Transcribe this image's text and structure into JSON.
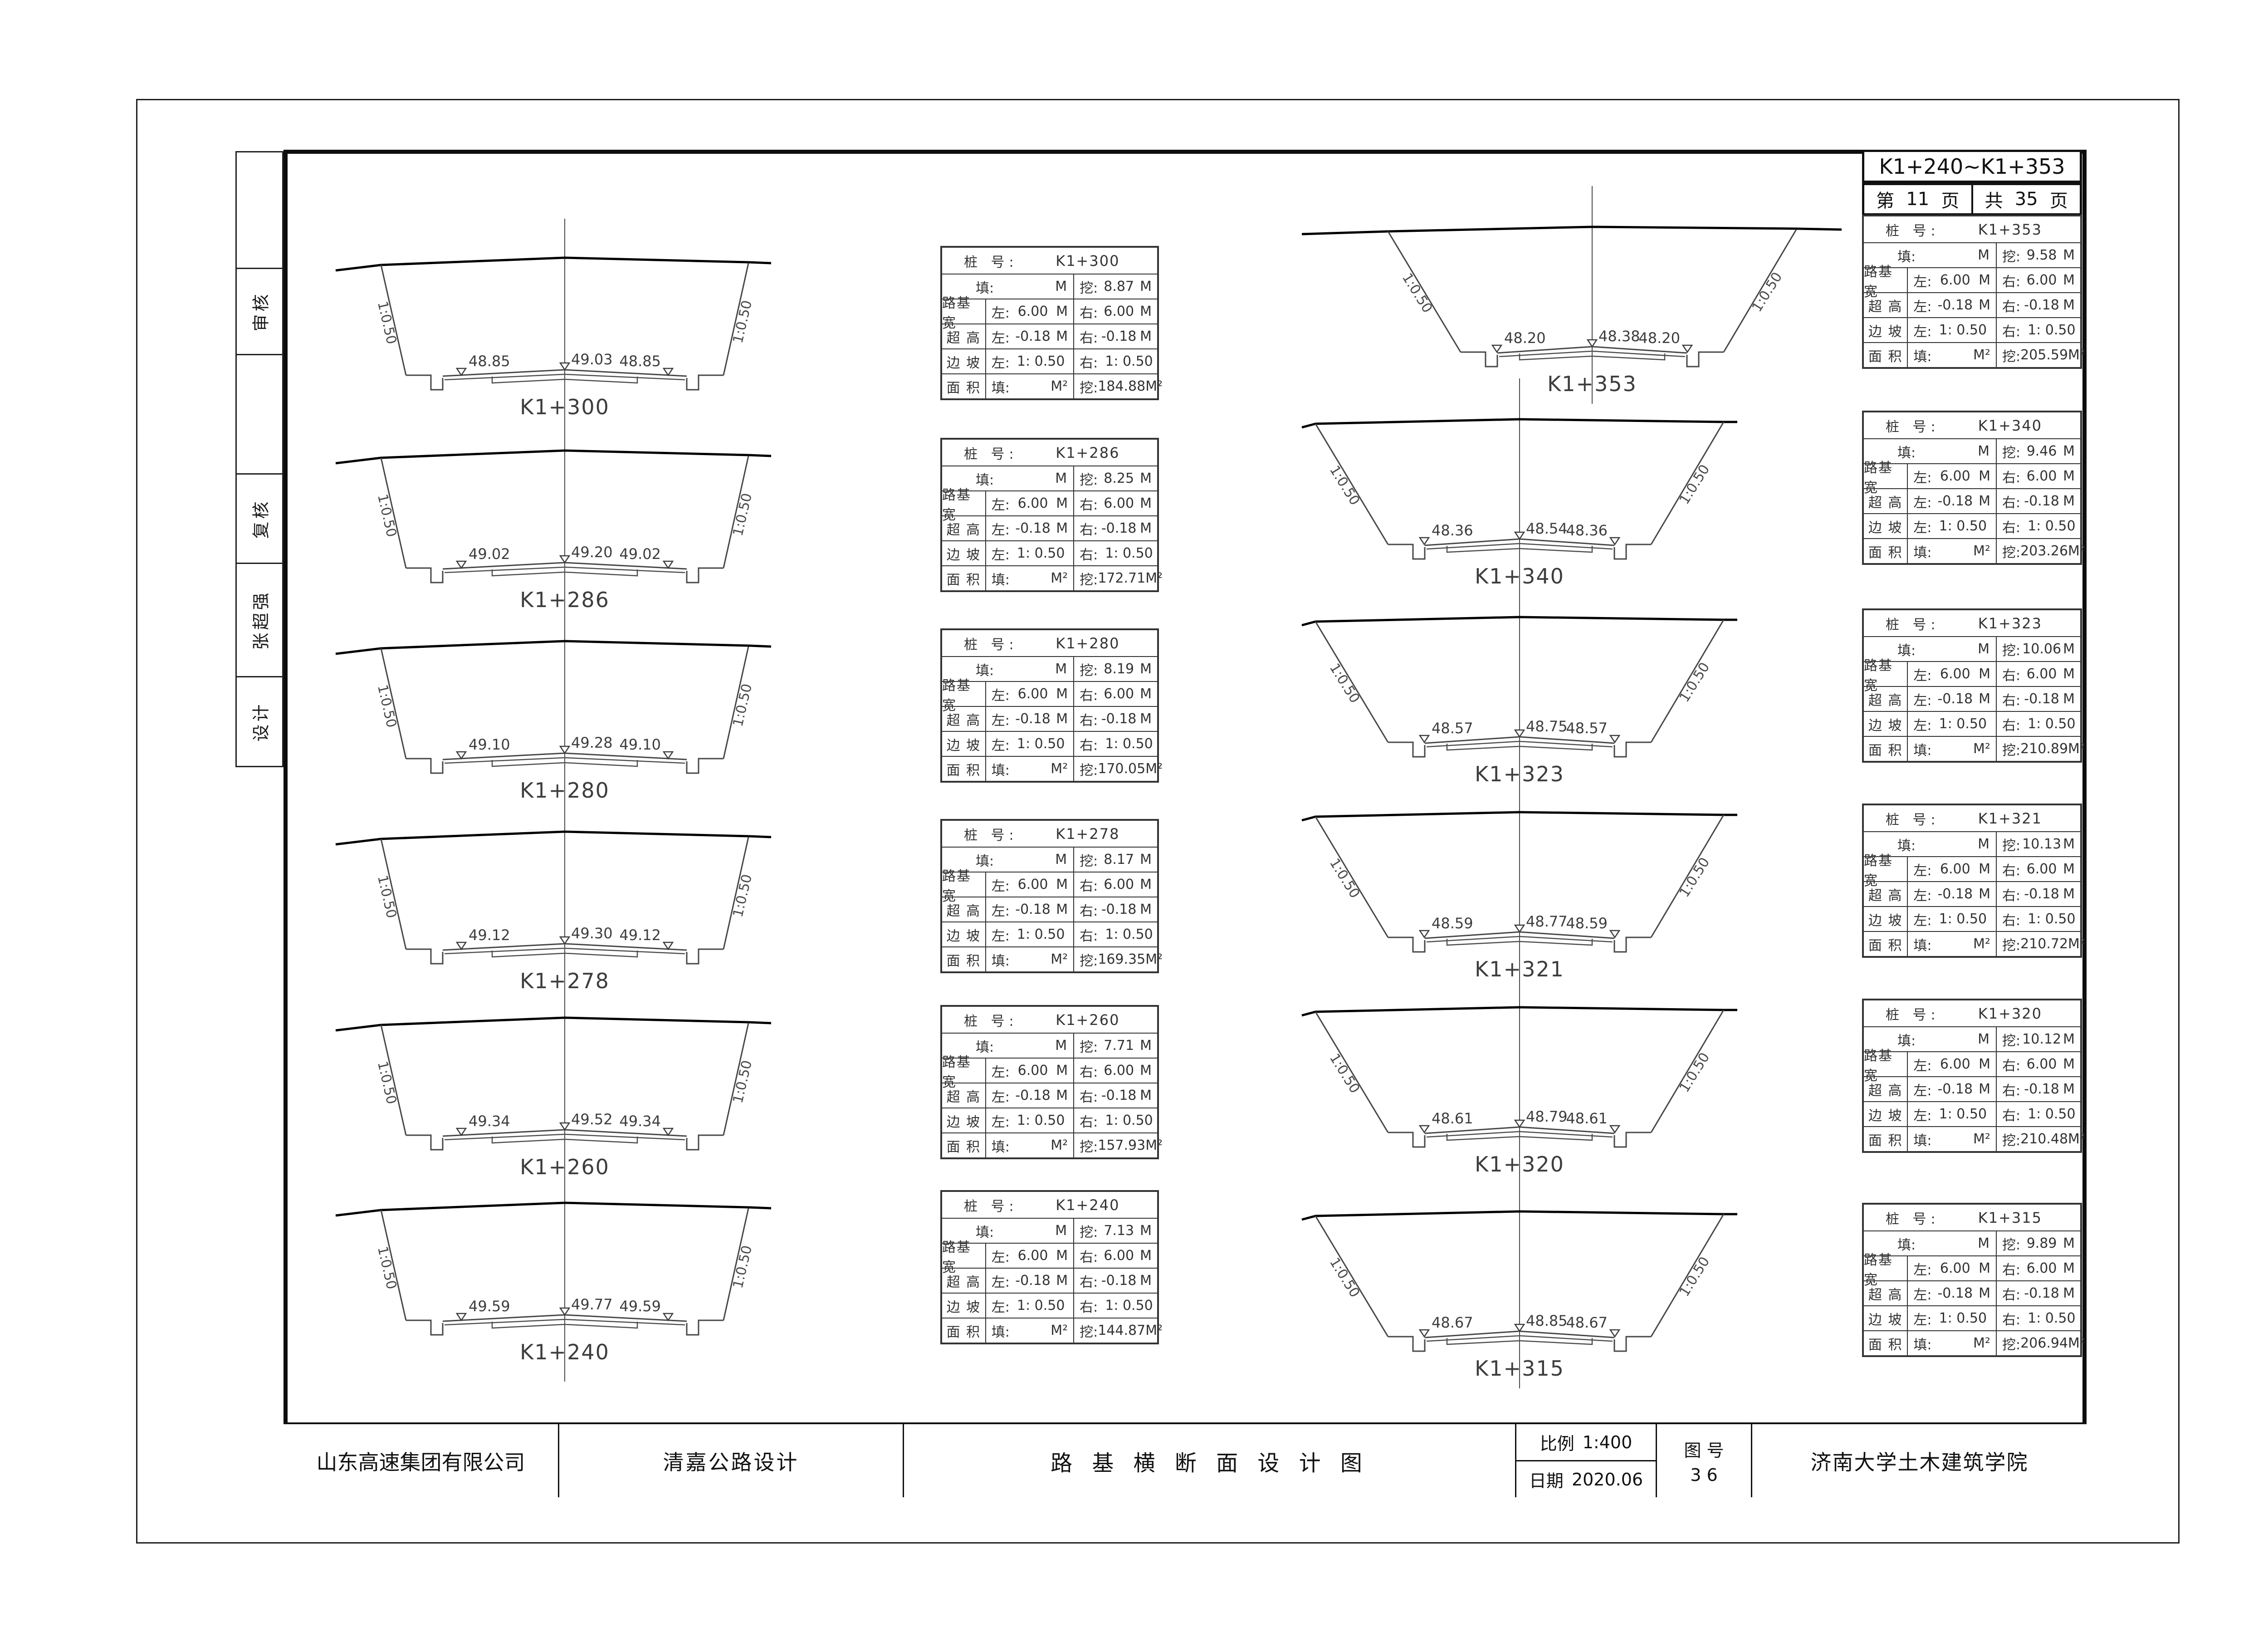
{
  "header": {
    "range_label": "K1+240~K1+353",
    "page_prefix": "第",
    "page_number": "11",
    "page_suffix": "页",
    "total_prefix": "共",
    "total_number": "35",
    "total_suffix": "页"
  },
  "sidebar": {
    "items": [
      "",
      "审核",
      "",
      "复核",
      "张超强",
      "设计"
    ]
  },
  "table_labels": {
    "station": "桩 号:",
    "fill": "填:",
    "cut": "挖:",
    "width": "路基宽",
    "superelevation": "超 高",
    "slope": "边 坡",
    "area": "面 积",
    "left": "左:",
    "right": "右:",
    "m": "M",
    "m2": "M²"
  },
  "sections_left": [
    {
      "station": "K1+300",
      "cut": "8.87",
      "area_cut": "184.88",
      "width_l": "6.00",
      "width_r": "6.00",
      "super_l": "-0.18",
      "super_r": "-0.18",
      "slope_l": "1: 0.50",
      "slope_r": "1: 0.50",
      "elev_left": "48.85",
      "elev_center": "49.03",
      "elev_right": "48.85",
      "slope_label": "1:0.50"
    },
    {
      "station": "K1+286",
      "cut": "8.25",
      "area_cut": "172.71",
      "width_l": "6.00",
      "width_r": "6.00",
      "super_l": "-0.18",
      "super_r": "-0.18",
      "slope_l": "1: 0.50",
      "slope_r": "1: 0.50",
      "elev_left": "49.02",
      "elev_center": "49.20",
      "elev_right": "49.02",
      "slope_label": "1:0.50"
    },
    {
      "station": "K1+280",
      "cut": "8.19",
      "area_cut": "170.05",
      "width_l": "6.00",
      "width_r": "6.00",
      "super_l": "-0.18",
      "super_r": "-0.18",
      "slope_l": "1: 0.50",
      "slope_r": "1: 0.50",
      "elev_left": "49.10",
      "elev_center": "49.28",
      "elev_right": "49.10",
      "slope_label": "1:0.50"
    },
    {
      "station": "K1+278",
      "cut": "8.17",
      "area_cut": "169.35",
      "width_l": "6.00",
      "width_r": "6.00",
      "super_l": "-0.18",
      "super_r": "-0.18",
      "slope_l": "1: 0.50",
      "slope_r": "1: 0.50",
      "elev_left": "49.12",
      "elev_center": "49.30",
      "elev_right": "49.12",
      "slope_label": "1:0.50"
    },
    {
      "station": "K1+260",
      "cut": "7.71",
      "area_cut": "157.93",
      "width_l": "6.00",
      "width_r": "6.00",
      "super_l": "-0.18",
      "super_r": "-0.18",
      "slope_l": "1: 0.50",
      "slope_r": "1: 0.50",
      "elev_left": "49.34",
      "elev_center": "49.52",
      "elev_right": "49.34",
      "slope_label": "1:0.50"
    },
    {
      "station": "K1+240",
      "cut": "7.13",
      "area_cut": "144.87",
      "width_l": "6.00",
      "width_r": "6.00",
      "super_l": "-0.18",
      "super_r": "-0.18",
      "slope_l": "1: 0.50",
      "slope_r": "1: 0.50",
      "elev_left": "49.59",
      "elev_center": "49.77",
      "elev_right": "49.59",
      "slope_label": "1:0.50"
    }
  ],
  "sections_right": [
    {
      "station": "K1+353",
      "cut": "9.58",
      "area_cut": "205.59",
      "width_l": "6.00",
      "width_r": "6.00",
      "super_l": "-0.18",
      "super_r": "-0.18",
      "slope_l": "1: 0.50",
      "slope_r": "1: 0.50",
      "elev_left": "48.20",
      "elev_center": "48.38",
      "elev_right": "48.20",
      "slope_label": "1:0.50"
    },
    {
      "station": "K1+340",
      "cut": "9.46",
      "area_cut": "203.26",
      "width_l": "6.00",
      "width_r": "6.00",
      "super_l": "-0.18",
      "super_r": "-0.18",
      "slope_l": "1: 0.50",
      "slope_r": "1: 0.50",
      "elev_left": "48.36",
      "elev_center": "48.54",
      "elev_right": "48.36",
      "slope_label": "1:0.50"
    },
    {
      "station": "K1+323",
      "cut": "10.06",
      "area_cut": "210.89",
      "width_l": "6.00",
      "width_r": "6.00",
      "super_l": "-0.18",
      "super_r": "-0.18",
      "slope_l": "1: 0.50",
      "slope_r": "1: 0.50",
      "elev_left": "48.57",
      "elev_center": "48.75",
      "elev_right": "48.57",
      "slope_label": "1:0.50"
    },
    {
      "station": "K1+321",
      "cut": "10.13",
      "area_cut": "210.72",
      "width_l": "6.00",
      "width_r": "6.00",
      "super_l": "-0.18",
      "super_r": "-0.18",
      "slope_l": "1: 0.50",
      "slope_r": "1: 0.50",
      "elev_left": "48.59",
      "elev_center": "48.77",
      "elev_right": "48.59",
      "slope_label": "1:0.50"
    },
    {
      "station": "K1+320",
      "cut": "10.12",
      "area_cut": "210.48",
      "width_l": "6.00",
      "width_r": "6.00",
      "super_l": "-0.18",
      "super_r": "-0.18",
      "slope_l": "1: 0.50",
      "slope_r": "1: 0.50",
      "elev_left": "48.61",
      "elev_center": "48.79",
      "elev_right": "48.61",
      "slope_label": "1:0.50"
    },
    {
      "station": "K1+315",
      "cut": "9.89",
      "area_cut": "206.94",
      "width_l": "6.00",
      "width_r": "6.00",
      "super_l": "-0.18",
      "super_r": "-0.18",
      "slope_l": "1: 0.50",
      "slope_r": "1: 0.50",
      "elev_left": "48.67",
      "elev_center": "48.85",
      "elev_right": "48.67",
      "slope_label": "1:0.50"
    }
  ],
  "titlebar": {
    "company": "山东高速集团有限公司",
    "project": "清嘉公路设计",
    "drawing_title": "路 基 横 断 面 设 计 图",
    "scale_label": "比例",
    "scale_value": "1:400",
    "date_label": "日期",
    "date_value": "2020.06",
    "figure_label": "图 号",
    "figure_number": "3 6",
    "institute": "济南大学土木建筑学院"
  }
}
